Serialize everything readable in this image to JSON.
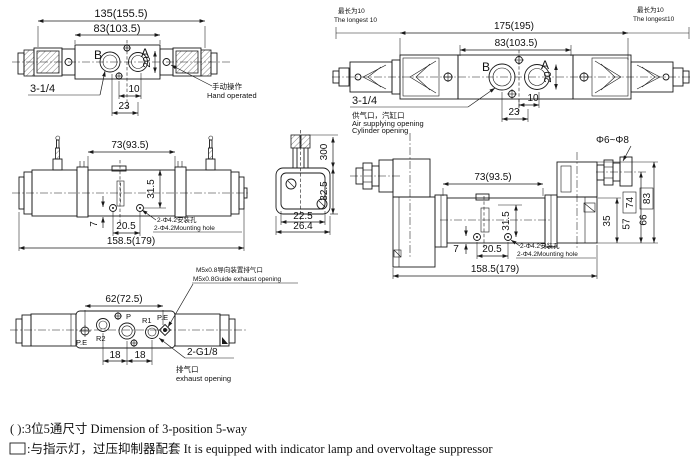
{
  "top_view_standard": {
    "dim_overall": "135(155.5)",
    "dim_body": "83(103.5)",
    "port_b": "B",
    "port_a": "A",
    "dim_port_height": "20",
    "dim_10": "10",
    "dim_23": "23",
    "thread_label": "3-1/4",
    "hand_note_cn": "手动操作",
    "hand_note_en": "Hand operated"
  },
  "top_view_plug": {
    "longest_left_cn": "最长为10",
    "longest_left_en": "The longest 10",
    "longest_right_cn": "最长为10",
    "longest_right_en": "The longest10",
    "dim_overall": "175(195)",
    "dim_body": "83(103.5)",
    "port_b": "B",
    "port_a": "A",
    "dim_port_height": "20",
    "dim_10": "10",
    "dim_23": "23",
    "thread_label": "3-1/4",
    "supply_note_cn": "供气口，汽缸口",
    "supply_note_en1": "Air supplying opening",
    "supply_note_en2": "Cylinder opening"
  },
  "front_view_wire": {
    "dim_body": "73(93.5)",
    "dim_height": "31.5",
    "dim_offset": "7",
    "dim_hole_span": "20.5",
    "dim_overall": "158.5(179)",
    "mount_note_cn": "2-Φ4.2安装孔",
    "mount_note_en": "2-Φ4.2Mounting hole"
  },
  "side_view": {
    "dim_wire_length": "300",
    "dim_height": "32.5",
    "dim_inner_width": "22.5",
    "dim_width": "26.4"
  },
  "front_view_plug": {
    "cable_dia": "Φ6~Φ8",
    "dim_body": "73(93.5)",
    "dim_height": "31.5",
    "dim_offset": "7",
    "dim_hole_span": "20.5",
    "dim_overall": "158.5(179)",
    "dim_sol_height": "35",
    "dim_h1": "57",
    "dim_h1_box": "74",
    "dim_h2": "66",
    "dim_h2_box": "83",
    "mount_note_cn": "2-Φ4.2安装孔",
    "mount_note_en": "2-Φ4.2Mounting hole"
  },
  "bottom_view": {
    "guide_note_cn": "M5x0.8导向装置排气口",
    "guide_note_en": "M5x0.8Guide exhaust opening",
    "dim_span": "62(72.5)",
    "dim_18a": "18",
    "dim_18b": "18",
    "port_pe_left": "P.E",
    "port_r2": "R2",
    "port_p": "P",
    "port_r1": "R1",
    "port_pe_right": "P.E",
    "thread_label": "2-G1/8",
    "exhaust_note_cn": "排气口",
    "exhaust_note_en": "exhaust opening"
  },
  "legend": {
    "paren_note": "( ):3位5通尺寸 Dimension of 3-position 5-way",
    "box_note": ":与指示灯，过压抑制器配套 It is equipped with indicator lamp and overvoltage suppressor"
  }
}
